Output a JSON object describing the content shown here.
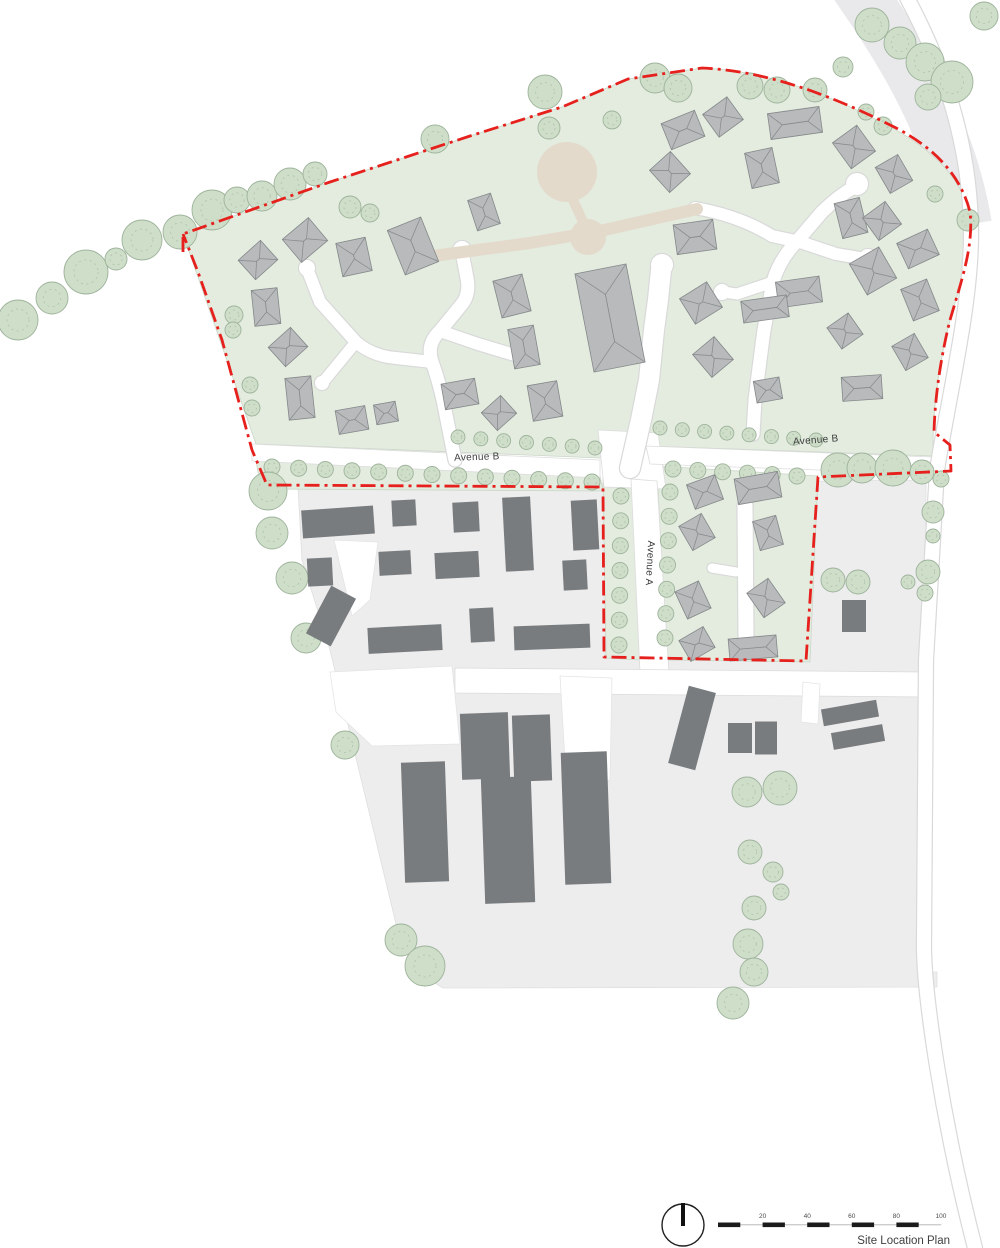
{
  "title": "Site Location Plan",
  "labels": {
    "avenue_b_left": "Avenue B",
    "avenue_b_right": "Avenue B",
    "avenue_a": "Avenue A"
  },
  "scale_bar": {
    "labels": [
      "20",
      "40",
      "60",
      "80",
      "100"
    ]
  },
  "colors": {
    "site_green": "#e3ecdf",
    "green_edge": "#cbd7c8",
    "tree_fill": "#cedec9",
    "tree_edge": "#9eb39b",
    "tree_inner": "#aec2ab",
    "ground_gray": "#ededee",
    "ground_edge": "#dfdfe0",
    "band_gray": "#e9e9eb",
    "road_white": "#ffffff",
    "road_edge": "#d9d9da",
    "tan": "#e3dacb",
    "roof_fill": "#b8babc",
    "roof_line": "#85888a",
    "building_dark": "#797c7e",
    "boundary_red": "#e6201c"
  },
  "map": {
    "bands": [
      {
        "d": "M852,-20 C905,55 950,130 966,225",
        "w": 52,
        "c": "#e9e9eb"
      }
    ],
    "ground": [
      {
        "d": "M298,487 L926,480 L925,972 L937,972 L937,987 L443,988 C418,974 403,948 397,928 L330,650 L302,560 Z",
        "f": "#ededee",
        "s": "#dfdfe0"
      },
      {
        "d": "M183,234 L330,182 L470,136 L562,107 L628,79 L702,68 C765,70 830,95 885,124 C935,150 960,178 969,212 C974,246 961,282 950,320 C941,356 934,396 933,440 L933,456 L648,446 L600,458 L256,444 Z",
        "f": "#e3ecdf",
        "s": "#cbd7c8"
      },
      {
        "d": "M256,460 L600,476 L603,491 L268,489 L258,472 Z",
        "f": "#e3ecdf",
        "s": "#cbd7c8"
      },
      {
        "d": "M603,477 L633,479 L641,660 L606,658 Z",
        "f": "#e3ecdf",
        "s": "#cbd7c8"
      },
      {
        "d": "M657,466 L818,476 L810,662 L666,660 Z",
        "f": "#e3ecdf",
        "s": "#cbd7c8"
      },
      {
        "d": "M598,430 L658,433 L666,489 L604,487 Z",
        "f": "#ffffff",
        "s": "#dcdcdd"
      },
      {
        "d": "M252,444 L600,460 L600,478 L252,461 Z",
        "f": "#ffffff",
        "s": "#dcdcdd"
      },
      {
        "d": "M646,446 L932,457 L932,474 L650,464 Z",
        "f": "#ffffff",
        "s": "#dcdcdd"
      },
      {
        "d": "M631,479 L657,481 L669,674 L640,672 Z",
        "f": "#ffffff",
        "s": "#dcdcdd"
      },
      {
        "d": "M455,668 L926,672 L926,697 L455,693 Z",
        "f": "#ffffff",
        "s": "#dcdcdd"
      },
      {
        "d": "M330,672 L452,666 L460,744 L372,746 L336,712 Z",
        "f": "#ffffff",
        "s": "#e4e4e5"
      },
      {
        "d": "M560,676 L612,678 L610,780 Q585,786 566,778 Z",
        "f": "#ffffff",
        "s": "#e4e4e5"
      },
      {
        "d": "M334,540 L378,542 L370,600 L352,616 Z",
        "f": "#ffffff",
        "s": "#e4e4e5"
      },
      {
        "d": "M803,682 L820,684 L818,724 L801,722 Z",
        "f": "#ffffff",
        "s": "#e4e4e5"
      }
    ],
    "roads": [
      {
        "d": "M900,-15 C948,70 970,150 971,230 C972,300 950,390 937,470 L926,660 L924,940 C923,990 942,1120 975,1248",
        "w": 14
      },
      {
        "d": "M455,460 L443,400 Q438,378 432,362 Q426,344 440,331 L462,304 Q470,294 467,278 L462,252",
        "w": 13
      },
      {
        "d": "M432,362 L396,358 Q372,356 356,342 L320,302 L308,271",
        "w": 12
      },
      {
        "d": "M356,342 L324,381",
        "w": 11
      },
      {
        "d": "M440,331 L478,344 L518,356",
        "w": 12
      },
      {
        "d": "M630,468 L641,420 L649,380 L654,330 L658,300 L661,270",
        "w": 20
      },
      {
        "d": "M695,208 Q740,216 772,236 L800,242",
        "w": 12
      },
      {
        "d": "M856,186 Q838,196 822,212 L798,240 Q779,260 773,282 L764,330 Q758,375 755,400 L753,434",
        "w": 13
      },
      {
        "d": "M800,242 L836,254 L866,259",
        "w": 12
      },
      {
        "d": "M773,282 L737,294 L724,292",
        "w": 11
      },
      {
        "d": "M745,506 L746,638",
        "w": 15
      },
      {
        "d": "M712,568 L736,572",
        "w": 9
      }
    ],
    "bulbs": [
      [
        462,
        250,
        9
      ],
      [
        307,
        268,
        8
      ],
      [
        322,
        383,
        7
      ],
      [
        522,
        357,
        8
      ],
      [
        662,
        265,
        11
      ],
      [
        857,
        184,
        11
      ],
      [
        868,
        258,
        9
      ],
      [
        722,
        292,
        8
      ]
    ],
    "tan_paths": [
      {
        "d": "M433,256 L530,243 L600,231 L697,209",
        "w": 12
      },
      {
        "d": "M573,200 L585,226",
        "w": 10
      }
    ],
    "tan_circles": [
      [
        567,
        172,
        30
      ],
      [
        588,
        237,
        18
      ]
    ],
    "tree_rows": [
      {
        "x1": 458,
        "y1": 437,
        "x2": 595,
        "y2": 448,
        "n": 7,
        "r": 7
      },
      {
        "x1": 272,
        "y1": 467,
        "x2": 592,
        "y2": 482,
        "n": 13,
        "r": 8
      },
      {
        "x1": 660,
        "y1": 428,
        "x2": 816,
        "y2": 440,
        "n": 8,
        "r": 7
      },
      {
        "x1": 673,
        "y1": 469,
        "x2": 797,
        "y2": 476,
        "n": 6,
        "r": 8
      },
      {
        "x1": 670,
        "y1": 492,
        "x2": 665,
        "y2": 638,
        "n": 7,
        "r": 8
      },
      {
        "x1": 621,
        "y1": 496,
        "x2": 619,
        "y2": 645,
        "n": 7,
        "r": 8
      }
    ],
    "trees": [
      [
        18,
        320,
        20
      ],
      [
        52,
        298,
        16
      ],
      [
        86,
        272,
        22
      ],
      [
        116,
        259,
        11
      ],
      [
        142,
        240,
        20
      ],
      [
        180,
        232,
        17
      ],
      [
        212,
        210,
        20
      ],
      [
        237,
        200,
        13
      ],
      [
        262,
        196,
        15
      ],
      [
        290,
        184,
        16
      ],
      [
        315,
        174,
        12
      ],
      [
        350,
        207,
        11
      ],
      [
        370,
        213,
        9
      ],
      [
        435,
        139,
        14
      ],
      [
        545,
        92,
        17
      ],
      [
        549,
        128,
        11
      ],
      [
        612,
        120,
        9
      ],
      [
        655,
        78,
        15
      ],
      [
        678,
        88,
        14
      ],
      [
        750,
        86,
        13
      ],
      [
        777,
        90,
        13
      ],
      [
        815,
        90,
        12
      ],
      [
        843,
        67,
        10
      ],
      [
        872,
        25,
        17
      ],
      [
        900,
        43,
        16
      ],
      [
        925,
        62,
        19
      ],
      [
        952,
        82,
        21
      ],
      [
        928,
        97,
        13
      ],
      [
        984,
        16,
        14
      ],
      [
        866,
        112,
        8
      ],
      [
        883,
        126,
        9
      ],
      [
        935,
        194,
        8
      ],
      [
        968,
        220,
        11
      ],
      [
        234,
        315,
        9
      ],
      [
        233,
        330,
        8
      ],
      [
        250,
        385,
        8
      ],
      [
        252,
        408,
        8
      ],
      [
        838,
        470,
        17
      ],
      [
        862,
        468,
        15
      ],
      [
        893,
        468,
        18
      ],
      [
        922,
        472,
        12
      ],
      [
        941,
        479,
        8
      ],
      [
        933,
        512,
        11
      ],
      [
        933,
        536,
        7
      ],
      [
        928,
        572,
        12
      ],
      [
        908,
        582,
        7
      ],
      [
        925,
        593,
        8
      ],
      [
        833,
        580,
        12
      ],
      [
        858,
        582,
        12
      ],
      [
        268,
        491,
        19
      ],
      [
        272,
        533,
        16
      ],
      [
        292,
        578,
        16
      ],
      [
        306,
        638,
        15
      ],
      [
        345,
        745,
        14
      ],
      [
        401,
        940,
        16
      ],
      [
        425,
        966,
        20
      ],
      [
        747,
        792,
        15
      ],
      [
        780,
        788,
        17
      ],
      [
        750,
        852,
        12
      ],
      [
        773,
        872,
        10
      ],
      [
        781,
        892,
        8
      ],
      [
        754,
        908,
        12
      ],
      [
        748,
        944,
        15
      ],
      [
        754,
        972,
        14
      ],
      [
        733,
        1003,
        16
      ]
    ],
    "houses": [
      [
        258,
        260,
        30,
        26,
        -42
      ],
      [
        305,
        240,
        34,
        30,
        -40
      ],
      [
        354,
        257,
        30,
        34,
        -12
      ],
      [
        413,
        246,
        36,
        48,
        -22
      ],
      [
        266,
        307,
        26,
        36,
        -6
      ],
      [
        288,
        347,
        30,
        26,
        -42
      ],
      [
        300,
        398,
        26,
        42,
        -6
      ],
      [
        352,
        420,
        30,
        24,
        -10
      ],
      [
        386,
        413,
        22,
        20,
        -10
      ],
      [
        484,
        212,
        24,
        32,
        -18
      ],
      [
        512,
        296,
        30,
        38,
        -14
      ],
      [
        524,
        347,
        26,
        40,
        -10
      ],
      [
        460,
        394,
        34,
        26,
        -10
      ],
      [
        499,
        413,
        26,
        24,
        -42
      ],
      [
        545,
        401,
        30,
        36,
        -10
      ],
      [
        610,
        318,
        52,
        100,
        -11
      ],
      [
        683,
        130,
        36,
        28,
        -22
      ],
      [
        723,
        117,
        30,
        28,
        -36
      ],
      [
        795,
        123,
        52,
        26,
        -8
      ],
      [
        854,
        147,
        30,
        32,
        -36
      ],
      [
        670,
        172,
        28,
        30,
        -42
      ],
      [
        762,
        168,
        28,
        36,
        -12
      ],
      [
        894,
        174,
        26,
        30,
        -30
      ],
      [
        851,
        218,
        26,
        36,
        -14
      ],
      [
        882,
        221,
        28,
        28,
        -36
      ],
      [
        918,
        249,
        34,
        28,
        -25
      ],
      [
        695,
        237,
        40,
        30,
        -8
      ],
      [
        873,
        271,
        34,
        36,
        -30
      ],
      [
        799,
        292,
        44,
        26,
        -8
      ],
      [
        701,
        303,
        32,
        30,
        -32
      ],
      [
        765,
        309,
        46,
        22,
        -8
      ],
      [
        920,
        300,
        28,
        34,
        -22
      ],
      [
        845,
        331,
        26,
        26,
        -35
      ],
      [
        713,
        357,
        28,
        30,
        -40
      ],
      [
        768,
        390,
        26,
        22,
        -10
      ],
      [
        862,
        388,
        40,
        24,
        -4
      ],
      [
        910,
        352,
        26,
        28,
        -30
      ],
      [
        705,
        492,
        30,
        26,
        -20
      ],
      [
        758,
        488,
        44,
        26,
        -10
      ],
      [
        697,
        532,
        26,
        28,
        -30
      ],
      [
        768,
        533,
        24,
        30,
        -15
      ],
      [
        693,
        600,
        26,
        30,
        -25
      ],
      [
        766,
        598,
        26,
        30,
        -35
      ],
      [
        697,
        644,
        28,
        24,
        -30
      ],
      [
        753,
        648,
        48,
        22,
        -5
      ]
    ],
    "buildings": [
      [
        338,
        522,
        72,
        28,
        -4
      ],
      [
        404,
        513,
        24,
        26,
        -3
      ],
      [
        466,
        517,
        26,
        30,
        -3
      ],
      [
        518,
        534,
        28,
        74,
        -3
      ],
      [
        585,
        525,
        26,
        50,
        -3
      ],
      [
        320,
        572,
        25,
        28,
        -3
      ],
      [
        395,
        563,
        32,
        24,
        -3
      ],
      [
        457,
        565,
        44,
        26,
        -3
      ],
      [
        575,
        575,
        24,
        30,
        -3
      ],
      [
        331,
        616,
        28,
        54,
        28
      ],
      [
        405,
        639,
        74,
        26,
        -3
      ],
      [
        482,
        625,
        24,
        34,
        -3
      ],
      [
        552,
        637,
        76,
        24,
        -2
      ],
      [
        854,
        616,
        24,
        32,
        0
      ],
      [
        425,
        822,
        44,
        120,
        -2
      ],
      [
        485,
        746,
        48,
        66,
        -2
      ],
      [
        532,
        748,
        38,
        66,
        -2
      ],
      [
        508,
        840,
        50,
        126,
        -2
      ],
      [
        586,
        818,
        46,
        132,
        -2
      ],
      [
        692,
        728,
        28,
        80,
        15
      ],
      [
        740,
        738,
        24,
        30,
        0
      ],
      [
        766,
        738,
        22,
        33,
        0
      ],
      [
        850,
        713,
        56,
        17,
        -10
      ],
      [
        858,
        737,
        52,
        17,
        -10
      ]
    ],
    "boundary": "M183,252 L183,234 L330,182 L470,136 L562,107 L628,79 L702,68 C770,71 838,98 900,130 C940,152 962,180 970,212 C974,246 961,282 950,320 C941,356 935,396 934,432 L950,445 L951,471 L818,477 L806,661 L604,657 L603,487 L267,485 L252,450 L222,340 L198,272 L183,234"
  }
}
